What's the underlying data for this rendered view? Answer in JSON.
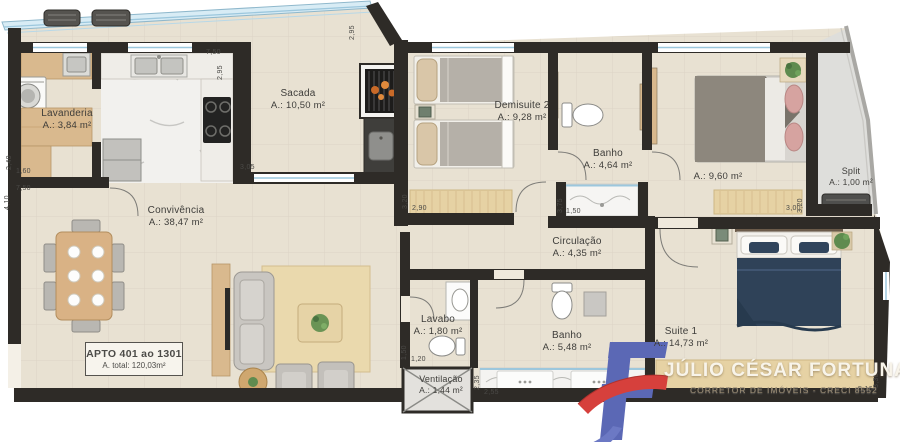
{
  "apartment": {
    "unit_label": "APTO 401 ao 1301",
    "total_area": "A. total: 120,03m²"
  },
  "rooms": {
    "lavanderia": {
      "name": "Lavanderia",
      "area": "A.: 3,84 m²"
    },
    "sacada": {
      "name": "Sacada",
      "area": "A.: 10,50 m²"
    },
    "demisuite2": {
      "name": "Demisuite 2",
      "area": "A.: 9,28 m²"
    },
    "banho1": {
      "name": "Banho",
      "area": "A.: 4,64 m²"
    },
    "quarto": {
      "name": "",
      "area": "A.: 9,60 m²"
    },
    "split": {
      "name": "Split",
      "area": "A.: 1,00 m²"
    },
    "convivencia": {
      "name": "Convivência",
      "area": "A.: 38,47 m²"
    },
    "circulacao": {
      "name": "Circulação",
      "area": "A.: 4,35 m²"
    },
    "lavabo": {
      "name": "Lavabo",
      "area": "A.: 1,80 m²"
    },
    "banho2": {
      "name": "Banho",
      "area": "A.: 5,48 m²"
    },
    "suite1": {
      "name": "Suite 1",
      "area": "A.: 14,73 m²"
    },
    "ventilacao": {
      "name": "Ventilação",
      "area": "A.: 1,44 m²"
    }
  },
  "dimensions": [
    "2,40",
    "1,60",
    "7,50",
    "4,10",
    "7,50",
    "2,95",
    "2,95",
    "3,05",
    "3,20",
    "2,90",
    "3,75",
    "1,50",
    "3,20",
    "3,00",
    "1,50",
    "1,20",
    "2,35",
    "2,55",
    "3,30",
    "5,16"
  ],
  "branding": {
    "realtor_name": "JÚLIO CÉSAR FORTUNA",
    "realtor_subtitle": "CORRETOR DE IMÓVEIS - CRECI 8552"
  },
  "colors": {
    "wall": "#2e2b27",
    "floor": "#e8e1d2",
    "wood": "#d9b98e",
    "rug": "#e6d2a4",
    "marble": "#f2f1ee",
    "glass_accent": "#9cc7dd",
    "suite_bed": "#2f4258",
    "logo_blue": "#5b68b5",
    "logo_red": "#d6403c"
  }
}
